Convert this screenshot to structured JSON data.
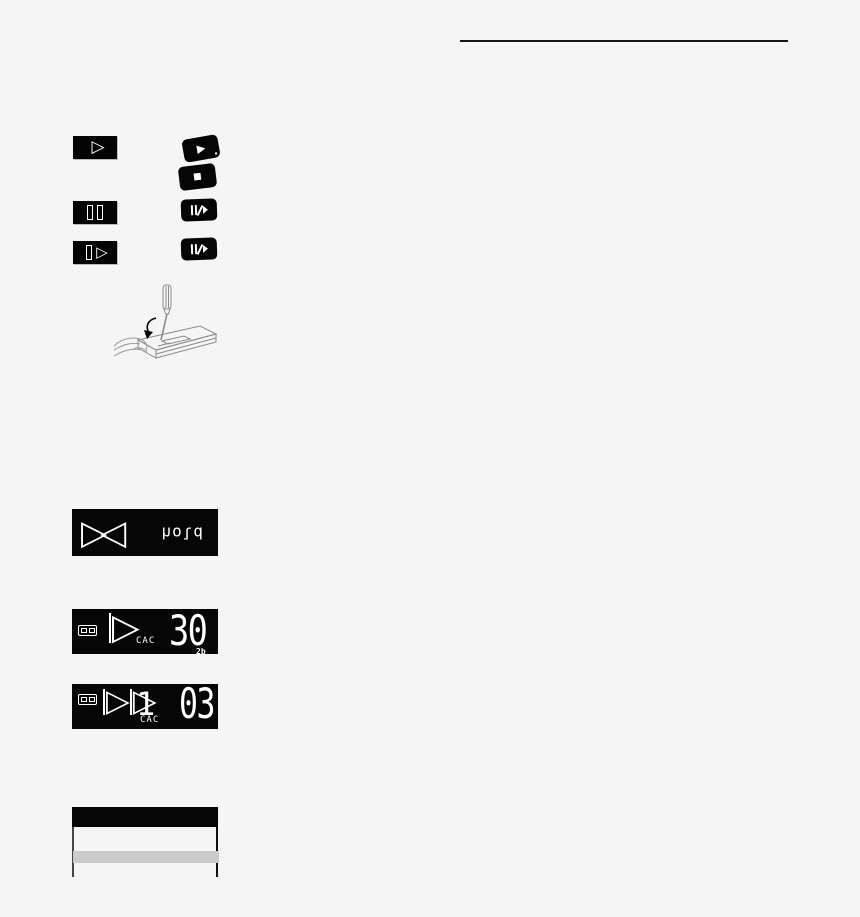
{
  "colors": {
    "background": "#f5f5f6",
    "ink": "#000000",
    "lcd_background": "#060606",
    "lcd_foreground": "#ffffff",
    "table_band": "#cbcbcb",
    "line_art": "#8a8a8a"
  },
  "legend": {
    "row1": {
      "remote_glyph": "▷",
      "unit_play_glyph": "▶",
      "unit_stop_glyph": "■"
    },
    "row3": {
      "remote_play_glyph": "▷"
    }
  },
  "displays": {
    "hold": {
      "triangles": "▷◁",
      "word": "hold"
    },
    "play": {
      "indicator": "▷",
      "label": "CAC",
      "value": "30",
      "sub_value": "2b"
    },
    "cue": {
      "indicator": "▷",
      "indicator2": "▷",
      "label": "CAC",
      "track": "1",
      "value": "03"
    }
  }
}
